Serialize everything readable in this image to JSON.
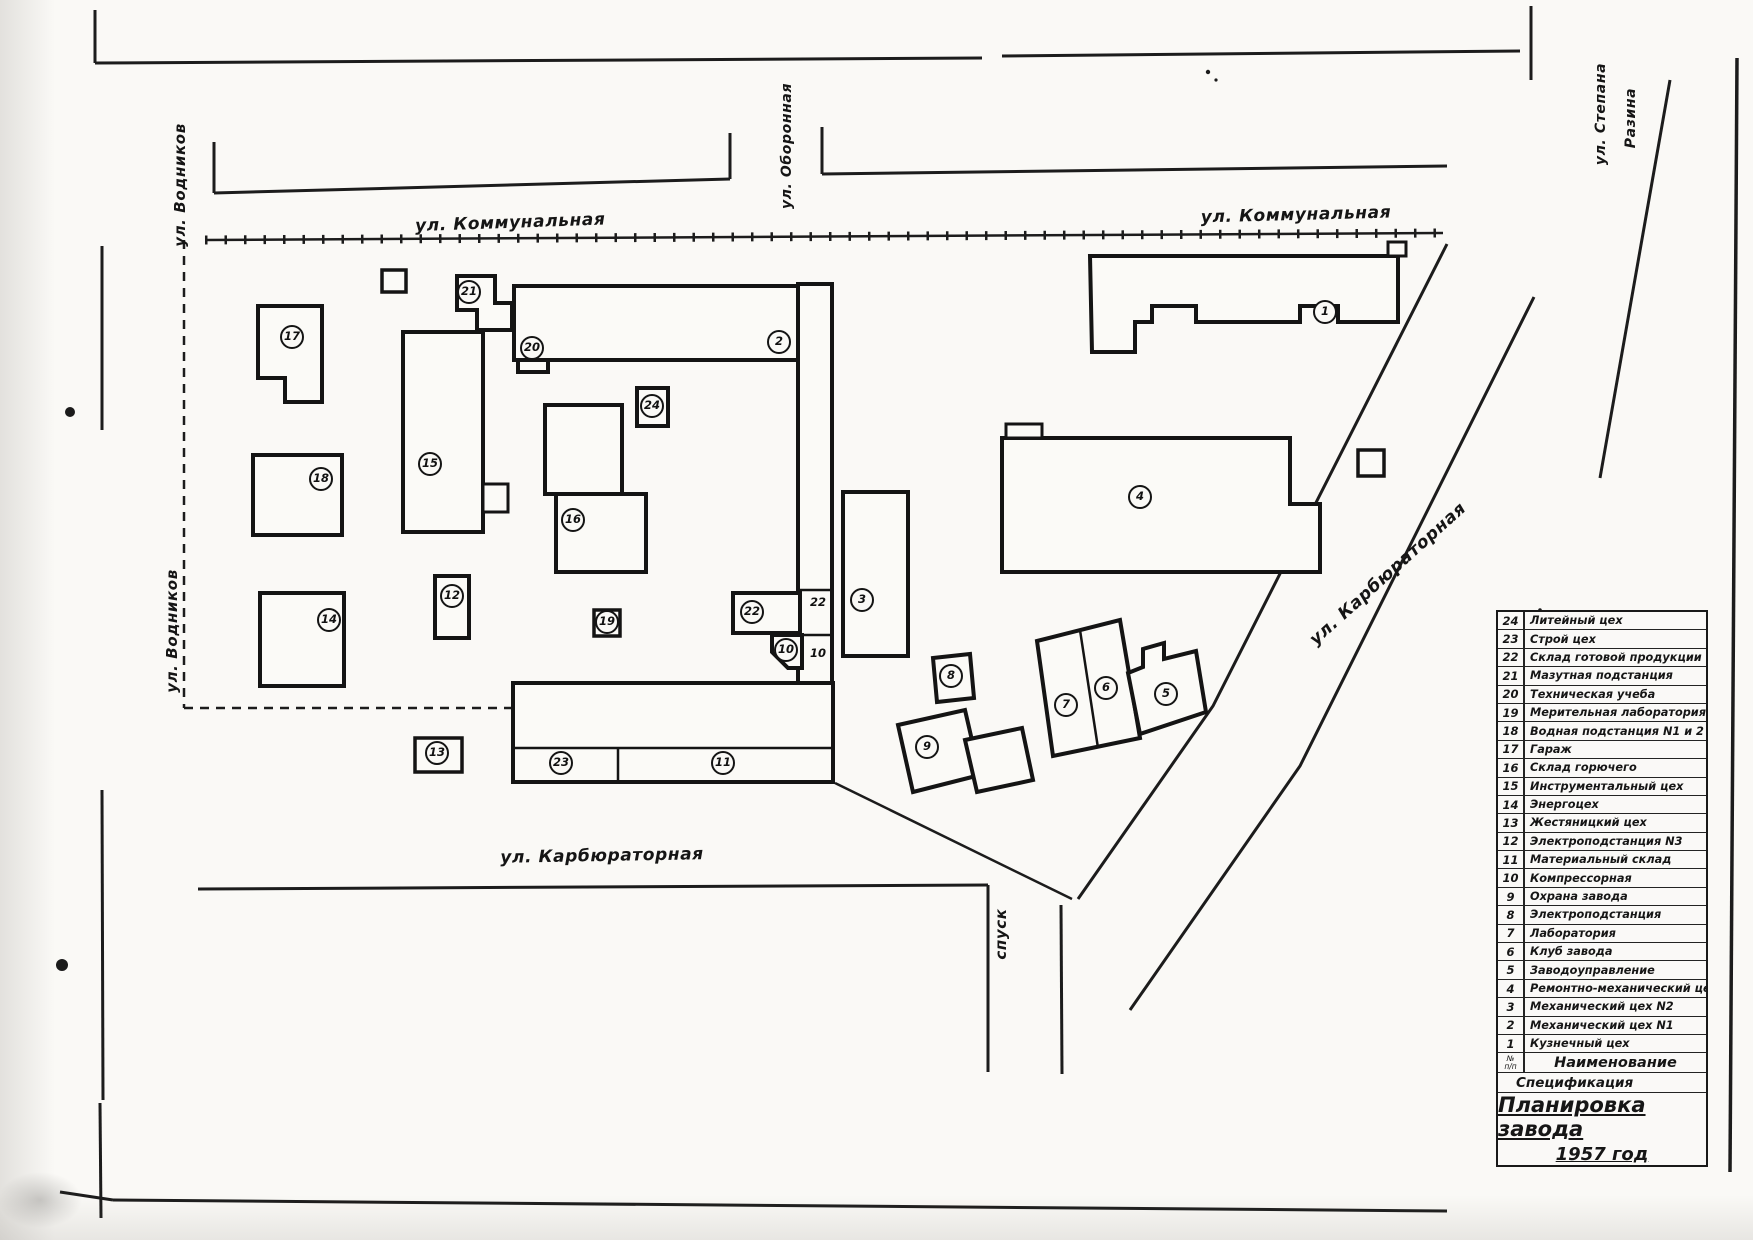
{
  "map": {
    "streets": {
      "vodnikov_top": "ул. Водников",
      "vodnikov_mid": "ул. Водников",
      "oboronnaya": "ул. Оборонная",
      "stepana": "ул. Степана",
      "razina": "Разина",
      "kommunalnaya_left": "ул. Коммунальная",
      "kommunalnaya_right": "ул. Коммунальная",
      "karbyuratornaya_diag": "ул. Карбюраторная",
      "karbyuratornaya_bottom": "ул. Карбюраторная",
      "spusk": "спуск"
    },
    "markers": [
      {
        "n": "1",
        "x": 1325,
        "y": 312
      },
      {
        "n": "2",
        "x": 779,
        "y": 342
      },
      {
        "n": "3",
        "x": 862,
        "y": 600
      },
      {
        "n": "4",
        "x": 1140,
        "y": 497
      },
      {
        "n": "5",
        "x": 1166,
        "y": 694
      },
      {
        "n": "6",
        "x": 1106,
        "y": 688
      },
      {
        "n": "7",
        "x": 1066,
        "y": 705
      },
      {
        "n": "8",
        "x": 951,
        "y": 676
      },
      {
        "n": "9",
        "x": 927,
        "y": 747
      },
      {
        "n": "10",
        "x": 786,
        "y": 650
      },
      {
        "n": "11",
        "x": 723,
        "y": 763
      },
      {
        "n": "12",
        "x": 452,
        "y": 596
      },
      {
        "n": "13",
        "x": 437,
        "y": 753
      },
      {
        "n": "14",
        "x": 329,
        "y": 620
      },
      {
        "n": "15",
        "x": 430,
        "y": 464
      },
      {
        "n": "16",
        "x": 573,
        "y": 520
      },
      {
        "n": "17",
        "x": 292,
        "y": 337
      },
      {
        "n": "18",
        "x": 321,
        "y": 479
      },
      {
        "n": "19",
        "x": 607,
        "y": 622
      },
      {
        "n": "20",
        "x": 532,
        "y": 348
      },
      {
        "n": "21",
        "x": 469,
        "y": 292
      },
      {
        "n": "22",
        "x": 752,
        "y": 612
      },
      {
        "n": "23",
        "x": 561,
        "y": 763
      },
      {
        "n": "24",
        "x": 652,
        "y": 406
      }
    ],
    "strip_labels": [
      {
        "n": "22",
        "x": 810,
        "y": 595
      },
      {
        "n": "10",
        "x": 810,
        "y": 646
      }
    ]
  },
  "legend": {
    "rows": [
      {
        "num": "24",
        "label": "Литейный цех"
      },
      {
        "num": "23",
        "label": "Строй цех"
      },
      {
        "num": "22",
        "label": "Склад готовой продукции"
      },
      {
        "num": "21",
        "label": "Мазутная подстанция"
      },
      {
        "num": "20",
        "label": "Техническая учеба"
      },
      {
        "num": "19",
        "label": "Мерительная лаборатория"
      },
      {
        "num": "18",
        "label": "Водная подстанция N1 и 2"
      },
      {
        "num": "17",
        "label": "Гараж"
      },
      {
        "num": "16",
        "label": "Склад горючего"
      },
      {
        "num": "15",
        "label": "Инструментальный цех"
      },
      {
        "num": "14",
        "label": "Энергоцех"
      },
      {
        "num": "13",
        "label": "Жестяницкий цех"
      },
      {
        "num": "12",
        "label": "Электроподстанция N3"
      },
      {
        "num": "11",
        "label": "Материальный склад"
      },
      {
        "num": "10",
        "label": "Компрессорная"
      },
      {
        "num": "9",
        "label": "Охрана завода"
      },
      {
        "num": "8",
        "label": "Электроподстанция"
      },
      {
        "num": "7",
        "label": "Лаборатория"
      },
      {
        "num": "6",
        "label": "Клуб завода"
      },
      {
        "num": "5",
        "label": "Заводоуправление"
      },
      {
        "num": "4",
        "label": "Ремонтно-механический цех"
      },
      {
        "num": "3",
        "label": "Механический цех N2"
      },
      {
        "num": "2",
        "label": "Механический цех N1"
      },
      {
        "num": "1",
        "label": "Кузнечный цех"
      }
    ],
    "header_num": "№\nп/п",
    "header_name": "Наименование",
    "specification": "Спецификация",
    "title_line1": "Планировка завода",
    "title_line2": "1957 год"
  }
}
